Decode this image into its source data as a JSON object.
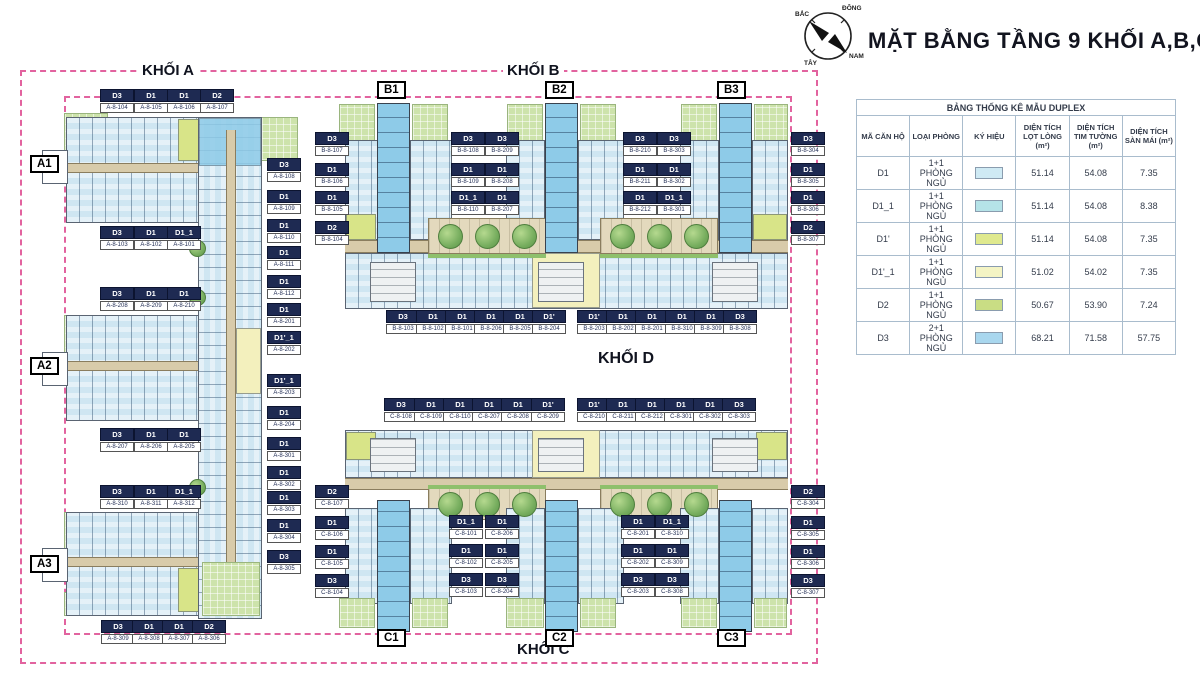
{
  "palette": {
    "boundary": "#e2639f",
    "navy": "#1e2a52",
    "unit": "#cfe6f2",
    "unitStrong": "#8ecbe8",
    "yellowGreen": "#d8e488",
    "paleYellow": "#f3f0bd",
    "lawn": "#cde3ab",
    "tree": "#76ad5e",
    "corridor": "#d8cbaa"
  },
  "header": {
    "title": "MẶT BẰNG TẦNG 9 KHỐI A,B,C"
  },
  "compass": {
    "north": "BẮC",
    "east": "ĐÔNG",
    "west": "TÂY",
    "south": "NAM"
  },
  "legend": {
    "title": "BẢNG THỐNG KÊ MẪU DUPLEX",
    "columns": [
      "MÃ CĂN HỘ",
      "LOẠI PHÒNG",
      "KÝ HIỆU",
      "DIỆN TÍCH LỌT LÒNG (m²)",
      "DIỆN TÍCH TIM TƯỜNG (m²)",
      "DIỆN TÍCH SÀN MÁI (m²)"
    ],
    "rows": [
      {
        "code": "D1",
        "type": "1+1 PHÒNG NGỦ",
        "color": "#cfeaf4",
        "net": "51.14",
        "wall": "54.08",
        "roof": "7.35"
      },
      {
        "code": "D1_1",
        "type": "1+1 PHÒNG NGỦ",
        "color": "#b5e3e8",
        "net": "51.14",
        "wall": "54.08",
        "roof": "8.38"
      },
      {
        "code": "D1'",
        "type": "1+1 PHÒNG NGỦ",
        "color": "#dfe98e",
        "net": "51.14",
        "wall": "54.08",
        "roof": "7.35"
      },
      {
        "code": "D1'_1",
        "type": "1+1 PHÒNG NGỦ",
        "color": "#f4f4c4",
        "net": "51.02",
        "wall": "54.02",
        "roof": "7.35"
      },
      {
        "code": "D2",
        "type": "1+1 PHÒNG NGỦ",
        "color": "#c9dd84",
        "net": "50.67",
        "wall": "53.90",
        "roof": "7.24"
      },
      {
        "code": "D3",
        "type": "2+1 PHÒNG NGỦ",
        "color": "#a9d7ee",
        "net": "68.21",
        "wall": "71.58",
        "roof": "57.75"
      }
    ]
  },
  "blocks": {
    "khoi_a": "KHỐI A",
    "khoi_b": "KHỐI B",
    "khoi_c": "KHỐI C",
    "khoi_d": "KHỐI D"
  },
  "towers": [
    {
      "label": "A1",
      "x": 30,
      "y": 155
    },
    {
      "label": "A2",
      "x": 30,
      "y": 357
    },
    {
      "label": "A3",
      "x": 30,
      "y": 555
    },
    {
      "label": "B1",
      "x": 377,
      "y": 81
    },
    {
      "label": "B2",
      "x": 545,
      "y": 81
    },
    {
      "label": "B3",
      "x": 717,
      "y": 81
    },
    {
      "label": "C1",
      "x": 377,
      "y": 629
    },
    {
      "label": "C2",
      "x": 545,
      "y": 629
    },
    {
      "label": "C3",
      "x": 717,
      "y": 629
    }
  ],
  "units": [
    {
      "t": "D3",
      "n": "A-8-104",
      "x": 100,
      "y": 89
    },
    {
      "t": "D1",
      "n": "A-8-105",
      "x": 134,
      "y": 89
    },
    {
      "t": "D1",
      "n": "A-8-106",
      "x": 167,
      "y": 89
    },
    {
      "t": "D2",
      "n": "A-8-107",
      "x": 200,
      "y": 89
    },
    {
      "t": "D3",
      "n": "A-8-103",
      "x": 100,
      "y": 226
    },
    {
      "t": "D1",
      "n": "A-8-102",
      "x": 134,
      "y": 226
    },
    {
      "t": "D1_1",
      "n": "A-8-101",
      "x": 167,
      "y": 226
    },
    {
      "t": "D3",
      "n": "A-8-208",
      "x": 100,
      "y": 287
    },
    {
      "t": "D1",
      "n": "A-8-209",
      "x": 134,
      "y": 287
    },
    {
      "t": "D1",
      "n": "A-8-210",
      "x": 167,
      "y": 287
    },
    {
      "t": "D3",
      "n": "A-8-207",
      "x": 100,
      "y": 428
    },
    {
      "t": "D1",
      "n": "A-8-206",
      "x": 134,
      "y": 428
    },
    {
      "t": "D1",
      "n": "A-8-205",
      "x": 167,
      "y": 428
    },
    {
      "t": "D3",
      "n": "A-8-310",
      "x": 100,
      "y": 485
    },
    {
      "t": "D1",
      "n": "A-8-311",
      "x": 134,
      "y": 485
    },
    {
      "t": "D1_1",
      "n": "A-8-312",
      "x": 167,
      "y": 485
    },
    {
      "t": "D3",
      "n": "A-8-309",
      "x": 101,
      "y": 620
    },
    {
      "t": "D1",
      "n": "A-8-308",
      "x": 132,
      "y": 620
    },
    {
      "t": "D1",
      "n": "A-8-307",
      "x": 162,
      "y": 620
    },
    {
      "t": "D2",
      "n": "A-8-306",
      "x": 192,
      "y": 620
    },
    {
      "t": "D3",
      "n": "A-8-108",
      "x": 267,
      "y": 158
    },
    {
      "t": "D1",
      "n": "A-8-109",
      "x": 267,
      "y": 190
    },
    {
      "t": "D1",
      "n": "A-8-110",
      "x": 267,
      "y": 219
    },
    {
      "t": "D1",
      "n": "A-8-111",
      "x": 267,
      "y": 246
    },
    {
      "t": "D1",
      "n": "A-8-112",
      "x": 267,
      "y": 275
    },
    {
      "t": "D1",
      "n": "A-8-201",
      "x": 267,
      "y": 303
    },
    {
      "t": "D1'_1",
      "n": "A-8-202",
      "x": 267,
      "y": 331
    },
    {
      "t": "D1'_1",
      "n": "A-8-203",
      "x": 267,
      "y": 374
    },
    {
      "t": "D1",
      "n": "A-8-204",
      "x": 267,
      "y": 406
    },
    {
      "t": "D1",
      "n": "A-8-301",
      "x": 267,
      "y": 437
    },
    {
      "t": "D1",
      "n": "A-8-302",
      "x": 267,
      "y": 466
    },
    {
      "t": "D1",
      "n": "A-8-303",
      "x": 267,
      "y": 491
    },
    {
      "t": "D1",
      "n": "A-8-304",
      "x": 267,
      "y": 519
    },
    {
      "t": "D3",
      "n": "A-8-305",
      "x": 267,
      "y": 550
    },
    {
      "t": "D3",
      "n": "B-8-107",
      "x": 315,
      "y": 132
    },
    {
      "t": "D1",
      "n": "B-8-106",
      "x": 315,
      "y": 163
    },
    {
      "t": "D1",
      "n": "B-8-105",
      "x": 315,
      "y": 191
    },
    {
      "t": "D2",
      "n": "B-8-104",
      "x": 315,
      "y": 221
    },
    {
      "t": "D3",
      "n": "B-8-108",
      "x": 451,
      "y": 132
    },
    {
      "t": "D1",
      "n": "B-8-109",
      "x": 451,
      "y": 163
    },
    {
      "t": "D1_1",
      "n": "B-8-110",
      "x": 451,
      "y": 191
    },
    {
      "t": "D3",
      "n": "B-8-209",
      "x": 485,
      "y": 132
    },
    {
      "t": "D1",
      "n": "B-8-208",
      "x": 485,
      "y": 163
    },
    {
      "t": "D1",
      "n": "B-8-207",
      "x": 485,
      "y": 191
    },
    {
      "t": "D3",
      "n": "B-8-210",
      "x": 623,
      "y": 132
    },
    {
      "t": "D1",
      "n": "B-8-211",
      "x": 623,
      "y": 163
    },
    {
      "t": "D1",
      "n": "B-8-212",
      "x": 623,
      "y": 191
    },
    {
      "t": "D3",
      "n": "B-8-303",
      "x": 657,
      "y": 132
    },
    {
      "t": "D1",
      "n": "B-8-302",
      "x": 657,
      "y": 163
    },
    {
      "t": "D1_1",
      "n": "B-8-301",
      "x": 657,
      "y": 191
    },
    {
      "t": "D3",
      "n": "B-8-304",
      "x": 791,
      "y": 132
    },
    {
      "t": "D1",
      "n": "B-8-305",
      "x": 791,
      "y": 163
    },
    {
      "t": "D1",
      "n": "B-8-306",
      "x": 791,
      "y": 191
    },
    {
      "t": "D2",
      "n": "B-8-307",
      "x": 791,
      "y": 221
    },
    {
      "t": "D3",
      "n": "B-8-103",
      "x": 386,
      "y": 310
    },
    {
      "t": "D1",
      "n": "B-8-102",
      "x": 416,
      "y": 310
    },
    {
      "t": "D1",
      "n": "B-8-101",
      "x": 445,
      "y": 310
    },
    {
      "t": "D1",
      "n": "B-8-206",
      "x": 474,
      "y": 310
    },
    {
      "t": "D1",
      "n": "B-8-205",
      "x": 503,
      "y": 310
    },
    {
      "t": "D1'",
      "n": "B-8-204",
      "x": 532,
      "y": 310
    },
    {
      "t": "D1'",
      "n": "B-8-203",
      "x": 577,
      "y": 310
    },
    {
      "t": "D1",
      "n": "B-8-202",
      "x": 606,
      "y": 310
    },
    {
      "t": "D1",
      "n": "B-8-201",
      "x": 635,
      "y": 310
    },
    {
      "t": "D1",
      "n": "B-8-310",
      "x": 665,
      "y": 310
    },
    {
      "t": "D1",
      "n": "B-8-309",
      "x": 694,
      "y": 310
    },
    {
      "t": "D3",
      "n": "B-8-308",
      "x": 723,
      "y": 310
    },
    {
      "t": "D3",
      "n": "C-8-108",
      "x": 384,
      "y": 398
    },
    {
      "t": "D1",
      "n": "C-8-109",
      "x": 414,
      "y": 398
    },
    {
      "t": "D1",
      "n": "C-8-110",
      "x": 443,
      "y": 398
    },
    {
      "t": "D1",
      "n": "C-8-207",
      "x": 472,
      "y": 398
    },
    {
      "t": "D1",
      "n": "C-8-208",
      "x": 501,
      "y": 398
    },
    {
      "t": "D1'",
      "n": "C-8-209",
      "x": 531,
      "y": 398
    },
    {
      "t": "D1'",
      "n": "C-8-210",
      "x": 577,
      "y": 398
    },
    {
      "t": "D1",
      "n": "C-8-211",
      "x": 606,
      "y": 398
    },
    {
      "t": "D1",
      "n": "C-8-212",
      "x": 635,
      "y": 398
    },
    {
      "t": "D1",
      "n": "C-8-301",
      "x": 664,
      "y": 398
    },
    {
      "t": "D1",
      "n": "C-8-302",
      "x": 693,
      "y": 398
    },
    {
      "t": "D3",
      "n": "C-8-303",
      "x": 722,
      "y": 398
    },
    {
      "t": "D2",
      "n": "C-8-107",
      "x": 315,
      "y": 485
    },
    {
      "t": "D1",
      "n": "C-8-106",
      "x": 315,
      "y": 516
    },
    {
      "t": "D1",
      "n": "C-8-105",
      "x": 315,
      "y": 545
    },
    {
      "t": "D3",
      "n": "C-8-104",
      "x": 315,
      "y": 574
    },
    {
      "t": "D1_1",
      "n": "C-8-101",
      "x": 449,
      "y": 515
    },
    {
      "t": "D1",
      "n": "C-8-102",
      "x": 449,
      "y": 544
    },
    {
      "t": "D3",
      "n": "C-8-103",
      "x": 449,
      "y": 573
    },
    {
      "t": "D1",
      "n": "C-8-206",
      "x": 485,
      "y": 515
    },
    {
      "t": "D1",
      "n": "C-8-205",
      "x": 485,
      "y": 544
    },
    {
      "t": "D3",
      "n": "C-8-204",
      "x": 485,
      "y": 573
    },
    {
      "t": "D1",
      "n": "C-8-201",
      "x": 621,
      "y": 515
    },
    {
      "t": "D1",
      "n": "C-8-202",
      "x": 621,
      "y": 544
    },
    {
      "t": "D3",
      "n": "C-8-203",
      "x": 621,
      "y": 573
    },
    {
      "t": "D1_1",
      "n": "C-8-310",
      "x": 655,
      "y": 515
    },
    {
      "t": "D1",
      "n": "C-8-309",
      "x": 655,
      "y": 544
    },
    {
      "t": "D3",
      "n": "C-8-308",
      "x": 655,
      "y": 573
    },
    {
      "t": "D2",
      "n": "C-8-304",
      "x": 791,
      "y": 485
    },
    {
      "t": "D1",
      "n": "C-8-305",
      "x": 791,
      "y": 516
    },
    {
      "t": "D1",
      "n": "C-8-306",
      "x": 791,
      "y": 545
    },
    {
      "t": "D3",
      "n": "C-8-307",
      "x": 791,
      "y": 574
    }
  ]
}
